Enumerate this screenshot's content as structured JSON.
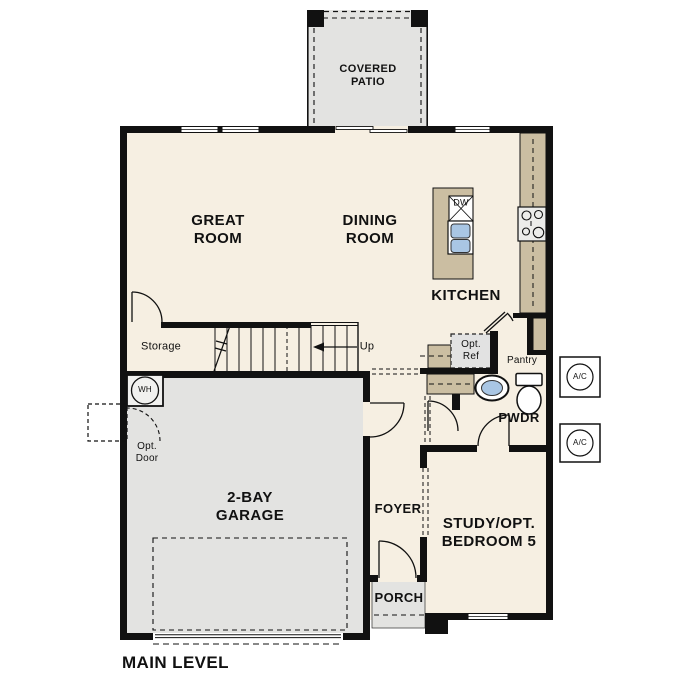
{
  "page": {
    "title": "MAIN LEVEL"
  },
  "colors": {
    "floor": "#F6EFE2",
    "patio_garage_porch": "#E3E3E1",
    "counter_tan": "#CBBEA2",
    "fixture_blue": "#A9C6E4",
    "wall": "#111111",
    "opt_ref_fill": "#E2E2E2"
  },
  "rooms": {
    "covered_patio": {
      "label": "COVERED\nPATIO"
    },
    "great_room": {
      "label": "GREAT\nROOM"
    },
    "dining_room": {
      "label": "DINING\nROOM"
    },
    "kitchen": {
      "label": "KITCHEN"
    },
    "storage": {
      "label": "Storage"
    },
    "pantry": {
      "label": "Pantry"
    },
    "powder": {
      "label": "PWDR"
    },
    "garage": {
      "label": "2-BAY\nGARAGE"
    },
    "foyer": {
      "label": "FOYER"
    },
    "porch": {
      "label": "PORCH"
    },
    "study": {
      "label": "STUDY/OPT.\nBEDROOM 5"
    }
  },
  "annotations": {
    "up": "Up",
    "water_heater": "WH",
    "dishwasher": "DW",
    "opt_ref": "Opt.\nRef",
    "opt_door": "Opt.\nDoor",
    "ac_unit_1": "A/C",
    "ac_unit_2": "A/C",
    "main_level": "MAIN LEVEL"
  }
}
